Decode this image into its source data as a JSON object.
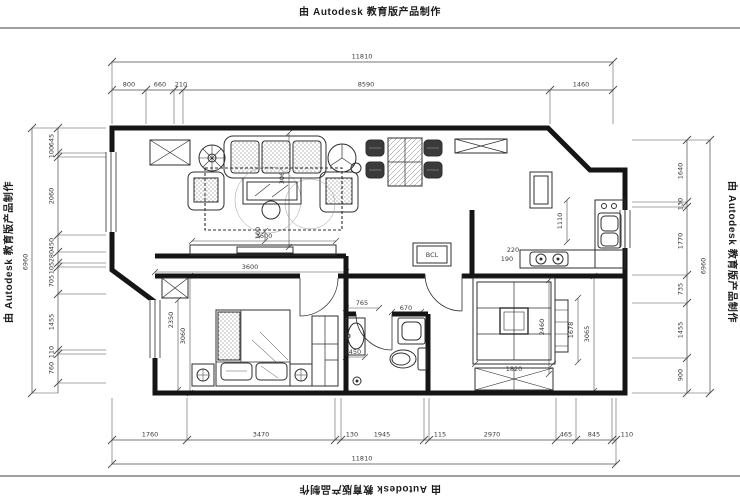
{
  "watermark": {
    "text": "由 Autodesk 教育版产品制作"
  },
  "colors": {
    "background": "#ffffff",
    "wall": "#151515",
    "line": "#2f2f2f",
    "dim_line": "#4a4a4a",
    "dim_text": "#3b3b3b"
  },
  "dim_chains": [
    {
      "side": "top-total",
      "values": [
        "11810"
      ]
    },
    {
      "side": "top",
      "values": [
        "800",
        "660",
        "210",
        "8590",
        "1460"
      ]
    },
    {
      "side": "bottom",
      "values": [
        "1760",
        "3470",
        "130",
        "1945",
        "115",
        "2970",
        "465",
        "845",
        "110"
      ]
    },
    {
      "side": "bottom-total",
      "values": [
        "11810"
      ]
    },
    {
      "side": "left",
      "values": [
        "645",
        "100",
        "2060",
        "450",
        "280",
        "105",
        "705",
        "1455",
        "110",
        "760"
      ]
    },
    {
      "side": "left-total",
      "values": [
        "6960"
      ]
    },
    {
      "side": "right",
      "values": [
        "1640",
        "130",
        "1770",
        "735",
        "1455",
        "900"
      ]
    },
    {
      "side": "right-total",
      "values": [
        "6960"
      ]
    }
  ],
  "interior_dims": {
    "values": [
      "3600",
      "100",
      "3600",
      "3060",
      "2350",
      "3060",
      "1110",
      "220",
      "190",
      "765",
      "670",
      "450",
      "1820",
      "2460",
      "1678",
      "3065"
    ]
  },
  "room_items": {
    "fridge_label": "BCL"
  }
}
